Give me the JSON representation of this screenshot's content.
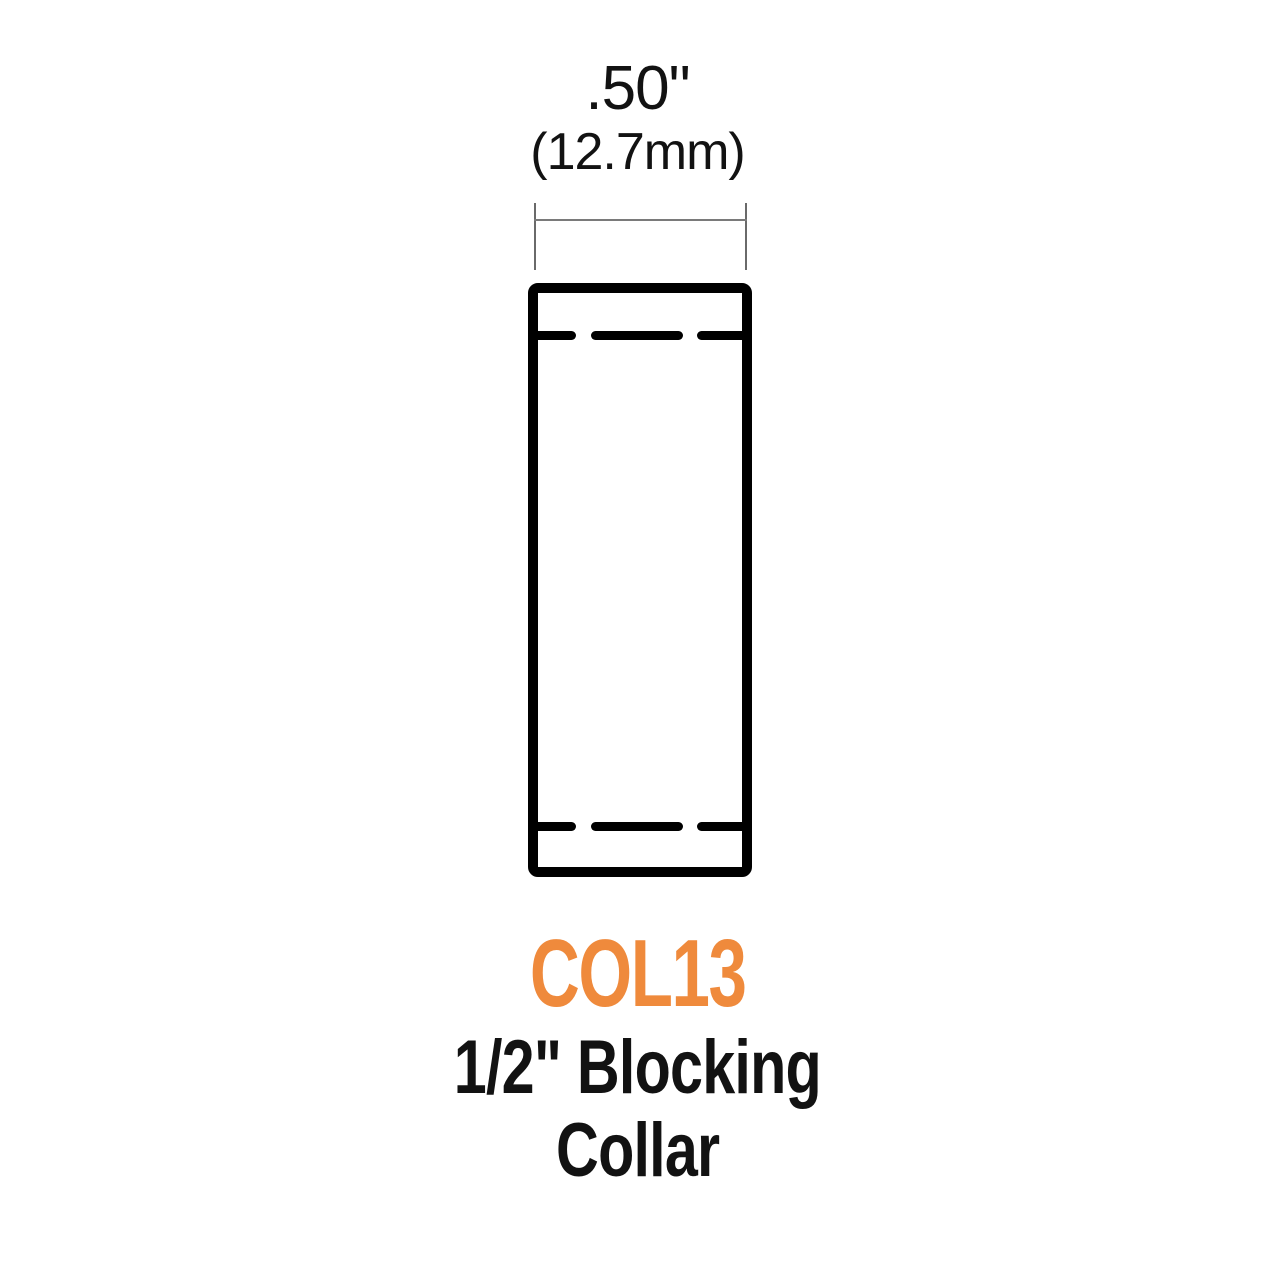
{
  "dimension": {
    "inches": ".50\"",
    "mm": "(12.7mm)"
  },
  "part": {
    "number": "COL13",
    "name_line1": "1/2\" Blocking",
    "name_line2": "Collar"
  },
  "colors": {
    "part_number_orange": "#EF8A3C",
    "label_text": "#121212",
    "drawing_stroke": "#000000",
    "dimension_line_gray": "#7A7A7A",
    "background": "#FFFFFF"
  }
}
